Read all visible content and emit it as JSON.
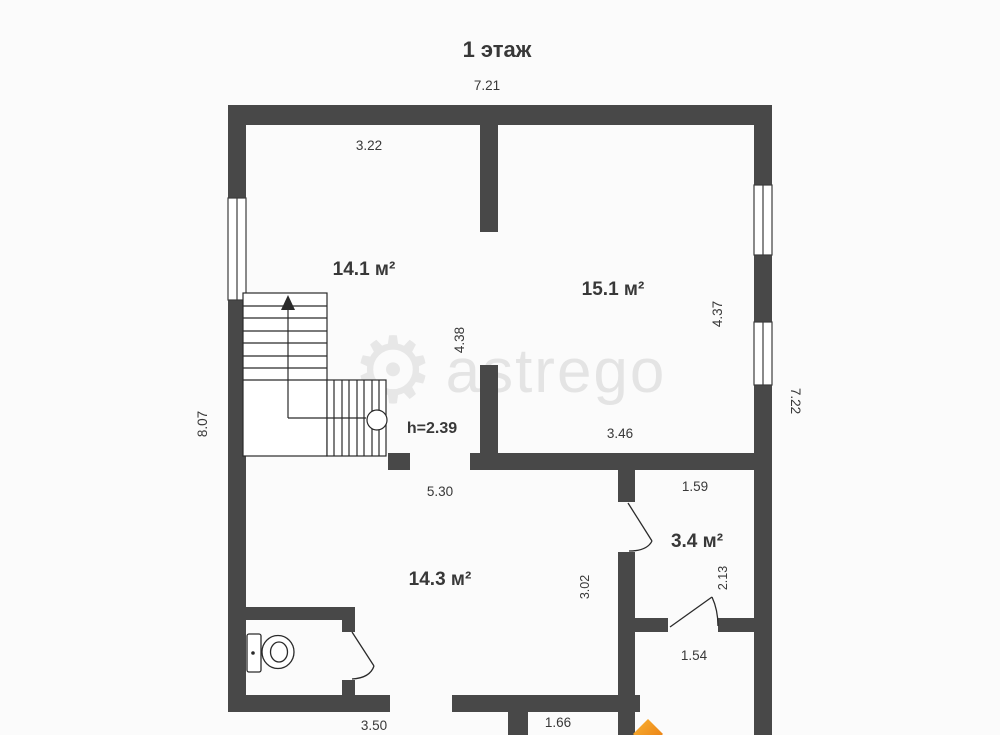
{
  "plan": {
    "title": "1 этаж",
    "watermark_text": "astrego",
    "height_note": "h=2.39",
    "rooms": [
      {
        "name": "stair-room",
        "area": "14.1 м²"
      },
      {
        "name": "living-room",
        "area": "15.1 м²"
      },
      {
        "name": "hall-room",
        "area": "14.3 м²"
      },
      {
        "name": "bath-room",
        "area": "3.4 м²"
      }
    ],
    "dims": {
      "building_width_top": "7.21",
      "stair_room_width": "3.22",
      "left_total_height": "8.07",
      "right_total_height": "7.22",
      "stair_wall_height": "4.38",
      "living_room_height": "4.37",
      "living_room_width": "3.46",
      "hall_width": "5.30",
      "bath_width": "1.59",
      "bath_height": "2.13",
      "hall_height": "3.02",
      "entry_width": "1.54",
      "bottom_left_width": "3.50",
      "porch_width": "1.66"
    },
    "colors": {
      "wall": "#484848",
      "line": "#2a2a2a",
      "label": "#383838",
      "watermark": "#d2d2d2",
      "logo_orange_light": "#f9b233",
      "logo_orange_dark": "#e8780f",
      "background": "#fbfbfb"
    }
  }
}
